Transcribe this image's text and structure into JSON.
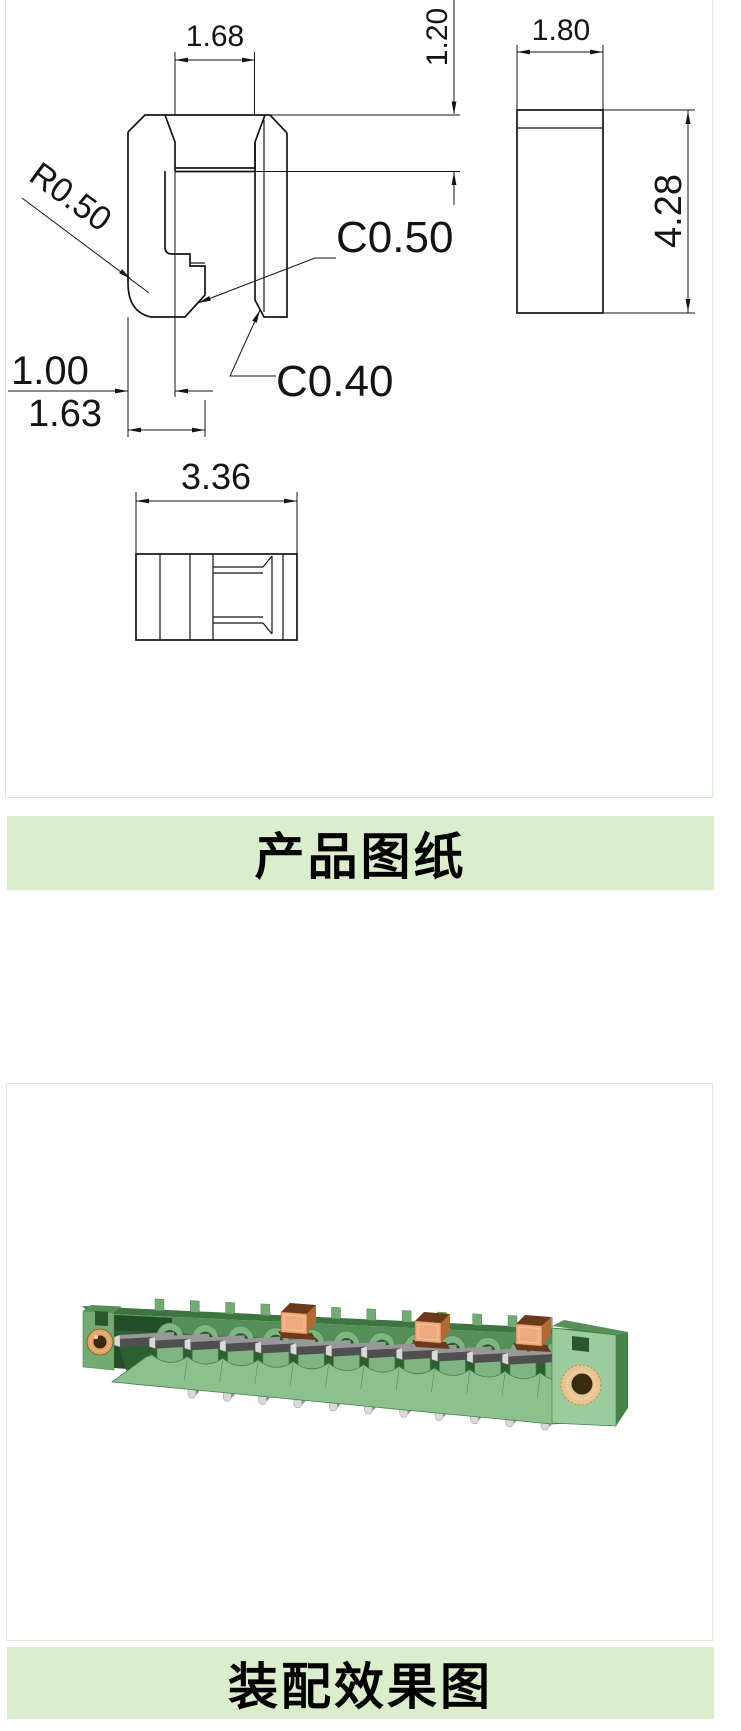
{
  "theme": {
    "page_bg": "#ffffff",
    "panel_border": "#d5edd1",
    "banner_bg": "#daedcc",
    "banner_text_color": "#000000",
    "drawing_line_color": "#141414"
  },
  "sections": {
    "drawing_banner": "产品图纸",
    "assembly_banner": "装配效果图"
  },
  "drawing": {
    "dimensions": {
      "slot_width": "1.68",
      "slot_depth": "1.20",
      "side_width": "1.80",
      "side_height": "4.28",
      "hook_width": "1.00",
      "base_width": "1.63",
      "overall_width": "3.36"
    },
    "callouts": {
      "radius": "R0.50",
      "chamfer_upper": "C0.50",
      "chamfer_lower": "C0.40"
    }
  },
  "assembly": {
    "pin_count": 12,
    "solder_pin_count": 11,
    "clip_count": 3,
    "clips": [
      {
        "x": 223,
        "y": 13
      },
      {
        "x": 357,
        "y": 22
      },
      {
        "x": 458,
        "y": 25
      }
    ],
    "colors": {
      "body_light": "#8cc08e",
      "body_mid": "#74ab74",
      "body_back": "#578f59",
      "top_dark": "#3c7540",
      "cap_front": "#9ccc9e",
      "cap_side": "#47824b",
      "trough": "#2e5f33",
      "recess": "#2b572f",
      "interior": "#234d28",
      "collar": "#7fb583",
      "edge": "#4a8050",
      "pin_dark": "#4f4f4f",
      "pin_top": "#989898",
      "pin_side": "#8f8f8f",
      "pin_light": "#d9d9d9",
      "copper_light": "#edaa7e",
      "copper_mid": "#b06a35",
      "copper_dark": "#6b3a1a",
      "eyelet": "#dda365",
      "eyelet_big": "#e9c391",
      "hole": "#3a2a12"
    }
  }
}
